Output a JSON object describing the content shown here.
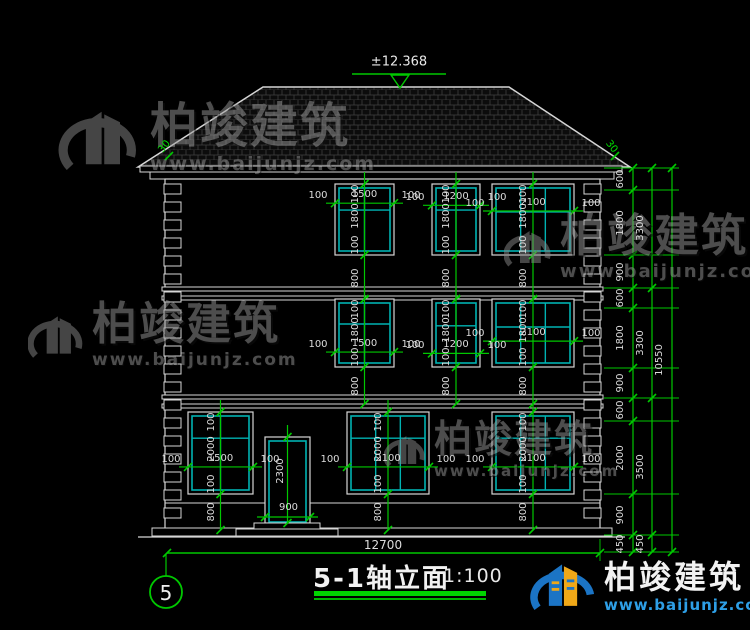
{
  "page": {
    "background": "#000000"
  },
  "title_block": {
    "axis_bubble": "5",
    "title": "5-1轴立面",
    "scale": "1:100"
  },
  "roof": {
    "elevation_label": "±12.368",
    "slope_labels": [
      "30",
      "30"
    ]
  },
  "watermarks": {
    "name": "柏竣建筑",
    "url": "www.baijunjz.com"
  },
  "logo": {
    "name": "柏竣建筑",
    "url": "www.baijunjz.com"
  },
  "dimensions": {
    "bottom_overall": "12700",
    "spacing_label": "100",
    "right_chain_inner": [
      "600",
      "1800",
      "900",
      "600",
      "1800",
      "900",
      "600",
      "2000",
      "900",
      "450"
    ],
    "right_chain_mid": [
      "3300",
      "3300",
      "3500",
      "450"
    ],
    "right_chain_outer": [
      "10550"
    ]
  },
  "drawing": {
    "colors": {
      "line": "#D6D6D6",
      "window": "#00B2B2",
      "dim": "#00C800",
      "text": "#DCDCDC",
      "hatch": "#3f3f3f"
    },
    "roof": {
      "polygon": "138,167 263,87 509,87 630,167",
      "marker": {
        "text_x": 399,
        "text_y": 62,
        "line": [
          352,
          74,
          446,
          74
        ],
        "tri": "391,75 409,75 400,88"
      },
      "slope_marks": [
        {
          "x": 165,
          "y": 147,
          "rot": -52
        },
        {
          "x": 611,
          "y": 147,
          "rot": 52
        }
      ]
    },
    "fascia": [
      [
        140,
        166,
        482,
        6
      ],
      [
        150,
        172,
        464,
        7
      ]
    ],
    "wall": {
      "x": 165,
      "y": 179,
      "w": 435,
      "h": 356,
      "plinth_y": 503
    },
    "base_strip": [
      152,
      528,
      460,
      8
    ],
    "ground_line": [
      138,
      537,
      625,
      537
    ],
    "floor_bands": [
      [
        162,
        287,
        441,
        4
      ],
      [
        162,
        296,
        441,
        4
      ],
      [
        162,
        395,
        441,
        4
      ],
      [
        162,
        404,
        441,
        4
      ]
    ],
    "quoins": {
      "cols": [
        164,
        584
      ],
      "w": 17,
      "top": 184,
      "bottom": 524,
      "box_h": 10,
      "step": 18
    },
    "windows": [
      {
        "x": 335,
        "y": 184,
        "w": 59,
        "h": 71,
        "width_label": "1500",
        "height_label": "1800",
        "sill_label": "800",
        "mullions": 1,
        "transom": 0.35,
        "dim_frac": 0.27,
        "v_to": 300
      },
      {
        "x": 432,
        "y": 184,
        "w": 48,
        "h": 71,
        "width_label": "1200",
        "height_label": "1800",
        "sill_label": "800",
        "mullions": 1,
        "transom": 0.35,
        "dim_frac": 0.3,
        "v_to": 300
      },
      {
        "x": 492,
        "y": 184,
        "w": 82,
        "h": 71,
        "width_label": "2100",
        "height_label": "1800",
        "sill_label": "800",
        "mullions": 2,
        "transom": 0.38,
        "dim_frac": 0.38,
        "v_to": 300
      },
      {
        "x": 335,
        "y": 299,
        "w": 59,
        "h": 68,
        "width_label": "1500",
        "height_label": "1800",
        "sill_label": "800",
        "mullions": 1,
        "transom": 0.35,
        "dim_frac": 0.78,
        "v_to": 404
      },
      {
        "x": 432,
        "y": 299,
        "w": 48,
        "h": 68,
        "width_label": "1200",
        "height_label": "1800",
        "sill_label": "800",
        "mullions": 1,
        "transom": 0.38,
        "dim_frac": 0.8,
        "v_to": 404
      },
      {
        "x": 492,
        "y": 299,
        "w": 82,
        "h": 68,
        "width_label": "2100",
        "height_label": "1800",
        "sill_label": "800",
        "mullions": 2,
        "transom": 0.4,
        "dim_frac": 0.62,
        "v_to": 404
      },
      {
        "x": 188,
        "y": 412,
        "w": 65,
        "h": 82,
        "width_label": "1500",
        "height_label": "2000",
        "sill_label": "800",
        "mullions": 1,
        "transom": 0.3,
        "dim_frac": 0.67,
        "v_to": 530
      },
      {
        "x": 347,
        "y": 412,
        "w": 82,
        "h": 82,
        "width_label": "2100",
        "height_label": "2000",
        "sill_label": "800",
        "mullions": 2,
        "transom": 0.3,
        "dim_frac": 0.67,
        "v_to": 530
      },
      {
        "x": 492,
        "y": 412,
        "w": 82,
        "h": 82,
        "width_label": "2100",
        "height_label": "2000",
        "sill_label": "800",
        "mullions": 2,
        "transom": 0.3,
        "dim_frac": 0.67,
        "v_to": 530
      }
    ],
    "door": {
      "x": 265,
      "y": 437,
      "w": 45,
      "h": 86,
      "width_label": "900",
      "height_label": "2300",
      "dim_y": 517,
      "steps": [
        [
          254,
          523,
          66,
          6
        ],
        [
          236,
          529,
          102,
          7
        ]
      ]
    },
    "chains": {
      "xs": [
        633,
        652,
        672
      ],
      "label_xs": [
        621,
        641,
        660
      ],
      "bounds": [
        [
          168,
          190,
          255,
          288,
          308,
          368,
          398,
          421,
          494,
          535,
          552
        ],
        [
          168,
          288,
          398,
          535,
          552
        ],
        [
          168,
          552
        ]
      ],
      "witness": {
        "x1": 604,
        "x2": 679
      }
    },
    "bottom_dim": {
      "y": 553,
      "x1": 167,
      "x2": 600,
      "label_x": 383,
      "label_y": 545
    },
    "bubble": {
      "cx": 166,
      "cy": 592,
      "r": 16,
      "leader": [
        166,
        554,
        166,
        576
      ]
    }
  }
}
